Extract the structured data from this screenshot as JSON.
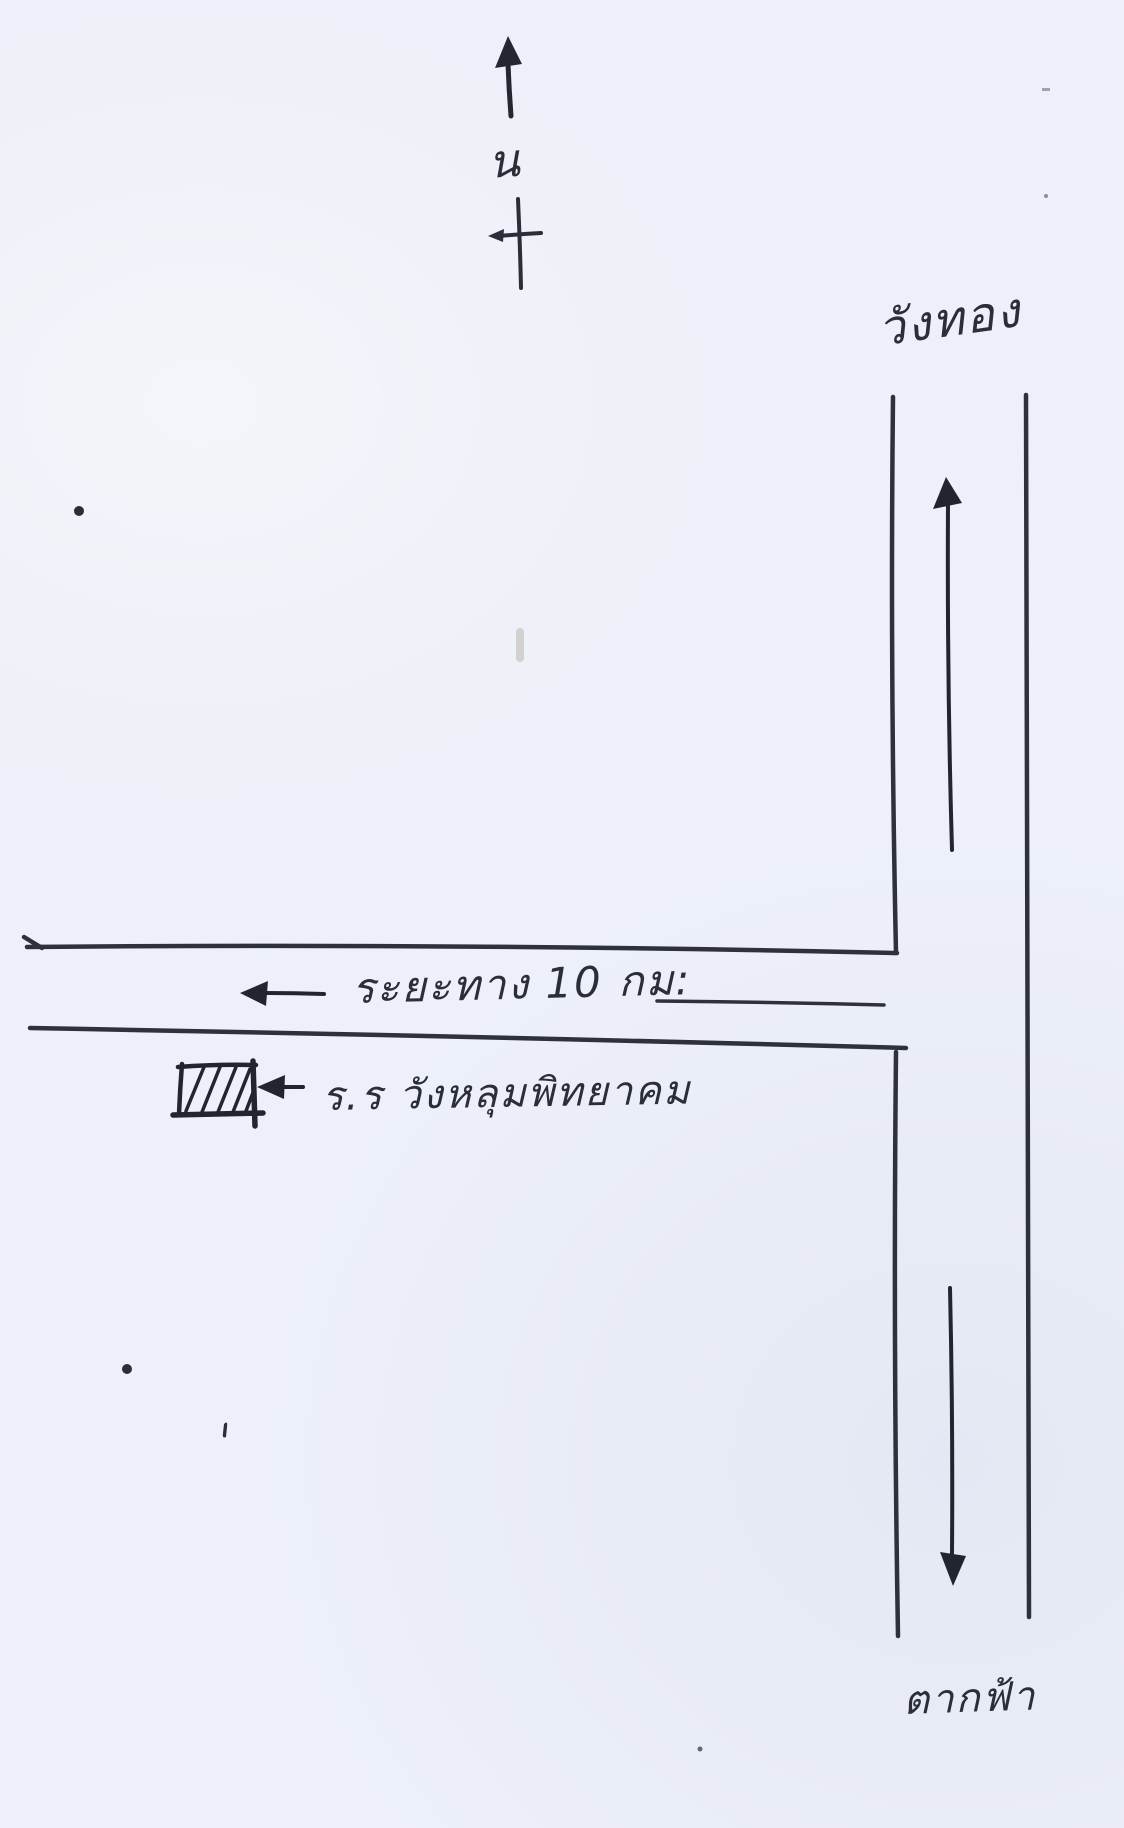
{
  "page": {
    "paper_color": "#edf0f8",
    "ink_color": "#2b2e38"
  },
  "compass": {
    "north_label": "น"
  },
  "roads": {
    "vertical_road": {
      "top_label": "วังทอง",
      "bottom_label": "ตากฟ้า"
    },
    "horizontal_road": {
      "distance_label": "ระยะทาง 10 กม:",
      "distance_km": 10
    }
  },
  "school": {
    "label": "ร.ร วังหลุมพิทยาคม"
  }
}
